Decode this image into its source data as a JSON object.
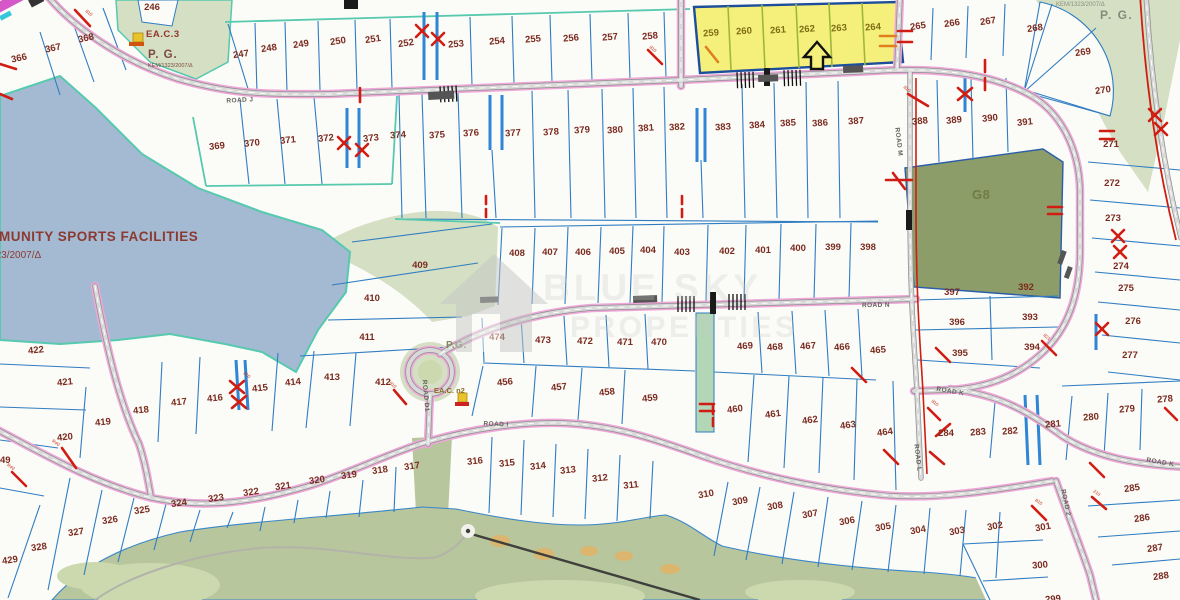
{
  "map": {
    "watermark": {
      "line1": "BLUE SKY",
      "line2": "PROPERTIES"
    },
    "colors": {
      "water": "#a4bad3",
      "green_light": "#d4dfc3",
      "golf": "#b7c69c",
      "golf_light": "#ccd9ae",
      "g8": "#8d9d69",
      "bunker": "#dcb56e",
      "highlight": "#f5f07c",
      "highlight_border": "#1d4e9c",
      "road_pink": "#efa6d9",
      "boundary_blue": "#2f7dc2",
      "teal": "#56c9ae",
      "red_mark": "#cf1d14",
      "orange_mark": "#e07f1e",
      "number": "#7b2b20"
    },
    "region_labels": [
      {
        "id": "community",
        "text": "COMMUNITY SPORTS FACILITIES",
        "x": -34,
        "y": 241,
        "size": 13.5,
        "color": "#8a3a30",
        "bold": true,
        "spacing": 0.5,
        "anchor": "start"
      },
      {
        "id": "community-ref",
        "text": "ΚΕΜ/1323/2007/Δ",
        "x": -40,
        "y": 258,
        "size": 10,
        "color": "#8a3a30",
        "bold": false,
        "spacing": 0,
        "anchor": "start"
      },
      {
        "id": "eac3",
        "text": "EA.C.3",
        "x": 146,
        "y": 37,
        "size": 9.5,
        "color": "#96352a",
        "bold": true,
        "spacing": 0.5,
        "anchor": "start"
      },
      {
        "id": "pg-topleft",
        "text": "P. G.",
        "x": 148,
        "y": 58,
        "size": 11.5,
        "color": "#7d4a40",
        "bold": true,
        "spacing": 1,
        "anchor": "start"
      },
      {
        "id": "kem-topleft",
        "text": "ΚΕΜ/1323/2007/Δ",
        "x": 148,
        "y": 67,
        "size": 5.5,
        "color": "#7d4a40",
        "bold": false,
        "spacing": 0,
        "anchor": "start"
      },
      {
        "id": "kem-topright",
        "text": "ΚΕΜ/1323/2007/Δ",
        "x": 1056,
        "y": 6,
        "size": 6,
        "color": "#8a8f80",
        "bold": false,
        "spacing": 0,
        "anchor": "start"
      },
      {
        "id": "pg-topright",
        "text": "P. G.",
        "x": 1100,
        "y": 19,
        "size": 12,
        "color": "#848b7a",
        "bold": true,
        "spacing": 1.5,
        "anchor": "start"
      },
      {
        "id": "g8",
        "text": "G8",
        "x": 972,
        "y": 199,
        "size": 13,
        "color": "#6d7d45",
        "bold": true,
        "spacing": 0.5,
        "anchor": "start"
      },
      {
        "id": "pg-mid",
        "text": "P.G.",
        "x": 446,
        "y": 348,
        "size": 10,
        "color": "#7d8a5a",
        "bold": true,
        "spacing": 0.5,
        "anchor": "start"
      },
      {
        "id": "eacn2",
        "text": "EA.C. n2",
        "x": 434,
        "y": 393,
        "size": 7.5,
        "color": "#8a6a20",
        "bold": true,
        "spacing": 0,
        "anchor": "start"
      },
      {
        "id": "num-49",
        "text": "49",
        "x": 0,
        "y": 463,
        "size": 9.5,
        "color": "#7b2b20",
        "bold": true,
        "spacing": 0,
        "anchor": "start"
      }
    ],
    "road_labels": [
      {
        "text": "ROAD J",
        "x": 240,
        "y": 102,
        "r": -3
      },
      {
        "text": "ROAD N",
        "x": 876,
        "y": 307,
        "r": -1
      },
      {
        "text": "ROAD M",
        "x": 897,
        "y": 142,
        "r": 83
      },
      {
        "text": "ROAD L",
        "x": 916,
        "y": 458,
        "r": 83
      },
      {
        "text": "ROAD D1",
        "x": 424,
        "y": 396,
        "r": 85
      },
      {
        "text": "ROAD I",
        "x": 496,
        "y": 426,
        "r": 2
      },
      {
        "text": "ROAD K",
        "x": 950,
        "y": 393,
        "r": 10
      },
      {
        "text": "ROAD K",
        "x": 1160,
        "y": 464,
        "r": 10
      },
      {
        "text": "ROAD 2",
        "x": 1064,
        "y": 503,
        "r": 78
      }
    ],
    "mark_labels": [
      {
        "t": "810",
        "x": 88,
        "y": 14,
        "r": 40
      },
      {
        "t": "810",
        "x": 652,
        "y": 50,
        "r": 40
      },
      {
        "t": "810",
        "x": 906,
        "y": 90,
        "r": 40
      },
      {
        "t": "821",
        "x": 1046,
        "y": 338,
        "r": 40
      },
      {
        "t": "810",
        "x": 934,
        "y": 404,
        "r": 40
      },
      {
        "t": "210",
        "x": 1096,
        "y": 494,
        "r": 35
      },
      {
        "t": "810",
        "x": 1038,
        "y": 503,
        "r": 35
      },
      {
        "t": "R40",
        "x": 55,
        "y": 444,
        "r": 35
      },
      {
        "t": "R40",
        "x": 10,
        "y": 468,
        "r": 35
      },
      {
        "t": "810",
        "x": 392,
        "y": 386,
        "r": 40
      },
      {
        "t": "810",
        "x": 246,
        "y": 376,
        "r": 40
      }
    ],
    "plots": [
      {
        "n": "246",
        "x": 152,
        "y": 7
      },
      {
        "n": "247",
        "x": 241,
        "y": 54,
        "r": -8
      },
      {
        "n": "248",
        "x": 269,
        "y": 48,
        "r": -8
      },
      {
        "n": "249",
        "x": 301,
        "y": 44,
        "r": -8
      },
      {
        "n": "250",
        "x": 338,
        "y": 41,
        "r": -8
      },
      {
        "n": "251",
        "x": 373,
        "y": 39,
        "r": -8
      },
      {
        "n": "252",
        "x": 406,
        "y": 43,
        "r": -8
      },
      {
        "n": "253",
        "x": 456,
        "y": 44,
        "r": -5
      },
      {
        "n": "254",
        "x": 497,
        "y": 41,
        "r": -5
      },
      {
        "n": "255",
        "x": 533,
        "y": 39,
        "r": -5
      },
      {
        "n": "256",
        "x": 571,
        "y": 38,
        "r": -5
      },
      {
        "n": "257",
        "x": 610,
        "y": 37,
        "r": -5
      },
      {
        "n": "258",
        "x": 650,
        "y": 36,
        "r": -5
      },
      {
        "n": "259",
        "x": 711,
        "y": 33,
        "r": -4,
        "c": "y"
      },
      {
        "n": "260",
        "x": 744,
        "y": 31,
        "r": -4,
        "c": "y"
      },
      {
        "n": "261",
        "x": 778,
        "y": 30,
        "r": -4,
        "c": "y"
      },
      {
        "n": "262",
        "x": 807,
        "y": 29,
        "r": -4,
        "c": "y"
      },
      {
        "n": "263",
        "x": 839,
        "y": 28,
        "r": -4,
        "c": "y"
      },
      {
        "n": "264",
        "x": 873,
        "y": 27,
        "r": -4,
        "c": "y"
      },
      {
        "n": "265",
        "x": 918,
        "y": 26,
        "r": -8
      },
      {
        "n": "266",
        "x": 952,
        "y": 23,
        "r": -8
      },
      {
        "n": "267",
        "x": 988,
        "y": 21,
        "r": -8
      },
      {
        "n": "268",
        "x": 1035,
        "y": 28,
        "r": -8
      },
      {
        "n": "269",
        "x": 1083,
        "y": 52,
        "r": -8
      },
      {
        "n": "270",
        "x": 1103,
        "y": 90,
        "r": -8
      },
      {
        "n": "271",
        "x": 1111,
        "y": 144
      },
      {
        "n": "272",
        "x": 1112,
        "y": 183
      },
      {
        "n": "273",
        "x": 1113,
        "y": 218
      },
      {
        "n": "274",
        "x": 1121,
        "y": 266
      },
      {
        "n": "275",
        "x": 1126,
        "y": 288
      },
      {
        "n": "276",
        "x": 1133,
        "y": 321
      },
      {
        "n": "277",
        "x": 1130,
        "y": 355
      },
      {
        "n": "278",
        "x": 1165,
        "y": 399,
        "r": -5
      },
      {
        "n": "279",
        "x": 1127,
        "y": 409,
        "r": -5
      },
      {
        "n": "280",
        "x": 1091,
        "y": 417,
        "r": -5
      },
      {
        "n": "281",
        "x": 1053,
        "y": 424,
        "r": -5
      },
      {
        "n": "282",
        "x": 1010,
        "y": 431,
        "r": -5
      },
      {
        "n": "283",
        "x": 978,
        "y": 432,
        "r": -5
      },
      {
        "n": "284",
        "x": 946,
        "y": 433
      },
      {
        "n": "285",
        "x": 1132,
        "y": 488,
        "r": -8
      },
      {
        "n": "286",
        "x": 1142,
        "y": 518,
        "r": -8
      },
      {
        "n": "287",
        "x": 1155,
        "y": 548,
        "r": -8
      },
      {
        "n": "288",
        "x": 1161,
        "y": 576,
        "r": -8
      },
      {
        "n": "299",
        "x": 1053,
        "y": 599,
        "r": -5
      },
      {
        "n": "300",
        "x": 1040,
        "y": 565,
        "r": -5
      },
      {
        "n": "301",
        "x": 1043,
        "y": 527,
        "r": -10
      },
      {
        "n": "302",
        "x": 995,
        "y": 526,
        "r": -10
      },
      {
        "n": "303",
        "x": 957,
        "y": 531,
        "r": -10
      },
      {
        "n": "304",
        "x": 918,
        "y": 530,
        "r": -10
      },
      {
        "n": "305",
        "x": 883,
        "y": 527,
        "r": -10
      },
      {
        "n": "306",
        "x": 847,
        "y": 521,
        "r": -10
      },
      {
        "n": "307",
        "x": 810,
        "y": 514,
        "r": -10
      },
      {
        "n": "308",
        "x": 775,
        "y": 506,
        "r": -10
      },
      {
        "n": "309",
        "x": 740,
        "y": 501,
        "r": -10
      },
      {
        "n": "310",
        "x": 706,
        "y": 494,
        "r": -10
      },
      {
        "n": "311",
        "x": 631,
        "y": 485,
        "r": -6
      },
      {
        "n": "312",
        "x": 600,
        "y": 478,
        "r": -6
      },
      {
        "n": "313",
        "x": 568,
        "y": 470,
        "r": -6
      },
      {
        "n": "314",
        "x": 538,
        "y": 466,
        "r": -6
      },
      {
        "n": "315",
        "x": 507,
        "y": 463,
        "r": -6
      },
      {
        "n": "316",
        "x": 475,
        "y": 461,
        "r": -6
      },
      {
        "n": "317",
        "x": 412,
        "y": 466,
        "r": -8
      },
      {
        "n": "318",
        "x": 380,
        "y": 470,
        "r": -8
      },
      {
        "n": "319",
        "x": 349,
        "y": 475,
        "r": -8
      },
      {
        "n": "320",
        "x": 317,
        "y": 480,
        "r": -8
      },
      {
        "n": "321",
        "x": 283,
        "y": 486,
        "r": -8
      },
      {
        "n": "322",
        "x": 251,
        "y": 492,
        "r": -8
      },
      {
        "n": "323",
        "x": 216,
        "y": 498,
        "r": -8
      },
      {
        "n": "324",
        "x": 179,
        "y": 503,
        "r": -8
      },
      {
        "n": "325",
        "x": 142,
        "y": 510,
        "r": -8
      },
      {
        "n": "326",
        "x": 110,
        "y": 520,
        "r": -8
      },
      {
        "n": "327",
        "x": 76,
        "y": 532,
        "r": -8
      },
      {
        "n": "328",
        "x": 39,
        "y": 547,
        "r": -8
      },
      {
        "n": "429",
        "x": 10,
        "y": 560,
        "r": -8
      },
      {
        "n": "366",
        "x": 19,
        "y": 58,
        "r": -12
      },
      {
        "n": "367",
        "x": 53,
        "y": 48,
        "r": -12
      },
      {
        "n": "368",
        "x": 86,
        "y": 38,
        "r": -12
      },
      {
        "n": "369",
        "x": 217,
        "y": 146,
        "r": -6
      },
      {
        "n": "370",
        "x": 252,
        "y": 143,
        "r": -6
      },
      {
        "n": "371",
        "x": 288,
        "y": 140,
        "r": -6
      },
      {
        "n": "372",
        "x": 326,
        "y": 138,
        "r": -6
      },
      {
        "n": "373",
        "x": 371,
        "y": 138,
        "r": -6
      },
      {
        "n": "374",
        "x": 398,
        "y": 135,
        "r": -4
      },
      {
        "n": "375",
        "x": 437,
        "y": 135,
        "r": -4
      },
      {
        "n": "376",
        "x": 471,
        "y": 133,
        "r": -4
      },
      {
        "n": "377",
        "x": 513,
        "y": 133,
        "r": -4
      },
      {
        "n": "378",
        "x": 551,
        "y": 132,
        "r": -4
      },
      {
        "n": "379",
        "x": 582,
        "y": 130,
        "r": -4
      },
      {
        "n": "380",
        "x": 615,
        "y": 130,
        "r": -4
      },
      {
        "n": "381",
        "x": 646,
        "y": 128,
        "r": -4
      },
      {
        "n": "382",
        "x": 677,
        "y": 127,
        "r": -4
      },
      {
        "n": "383",
        "x": 723,
        "y": 127,
        "r": -4
      },
      {
        "n": "384",
        "x": 757,
        "y": 125,
        "r": -4
      },
      {
        "n": "385",
        "x": 788,
        "y": 123,
        "r": -4
      },
      {
        "n": "386",
        "x": 820,
        "y": 123,
        "r": -4
      },
      {
        "n": "387",
        "x": 856,
        "y": 121,
        "r": -4
      },
      {
        "n": "388",
        "x": 920,
        "y": 121,
        "r": -6
      },
      {
        "n": "389",
        "x": 954,
        "y": 120,
        "r": -6
      },
      {
        "n": "390",
        "x": 990,
        "y": 118,
        "r": -6
      },
      {
        "n": "391",
        "x": 1025,
        "y": 122,
        "r": -6
      },
      {
        "n": "392",
        "x": 1026,
        "y": 287
      },
      {
        "n": "393",
        "x": 1030,
        "y": 317
      },
      {
        "n": "394",
        "x": 1032,
        "y": 347
      },
      {
        "n": "395",
        "x": 960,
        "y": 353
      },
      {
        "n": "396",
        "x": 957,
        "y": 322
      },
      {
        "n": "397",
        "x": 952,
        "y": 292
      },
      {
        "n": "398",
        "x": 868,
        "y": 247
      },
      {
        "n": "399",
        "x": 833,
        "y": 247
      },
      {
        "n": "400",
        "x": 798,
        "y": 248
      },
      {
        "n": "401",
        "x": 763,
        "y": 250
      },
      {
        "n": "402",
        "x": 727,
        "y": 251
      },
      {
        "n": "403",
        "x": 682,
        "y": 252
      },
      {
        "n": "404",
        "x": 648,
        "y": 250
      },
      {
        "n": "405",
        "x": 617,
        "y": 251
      },
      {
        "n": "406",
        "x": 583,
        "y": 252
      },
      {
        "n": "407",
        "x": 550,
        "y": 252
      },
      {
        "n": "408",
        "x": 517,
        "y": 253
      },
      {
        "n": "409",
        "x": 420,
        "y": 265
      },
      {
        "n": "410",
        "x": 372,
        "y": 298
      },
      {
        "n": "411",
        "x": 367,
        "y": 337
      },
      {
        "n": "412",
        "x": 383,
        "y": 382
      },
      {
        "n": "413",
        "x": 332,
        "y": 377
      },
      {
        "n": "414",
        "x": 293,
        "y": 382,
        "r": -6
      },
      {
        "n": "415",
        "x": 260,
        "y": 388,
        "r": -6
      },
      {
        "n": "416",
        "x": 215,
        "y": 398,
        "r": -6
      },
      {
        "n": "417",
        "x": 179,
        "y": 402,
        "r": -6
      },
      {
        "n": "418",
        "x": 141,
        "y": 410,
        "r": -6
      },
      {
        "n": "419",
        "x": 103,
        "y": 422,
        "r": -6
      },
      {
        "n": "420",
        "x": 65,
        "y": 437,
        "r": -6
      },
      {
        "n": "421",
        "x": 65,
        "y": 382,
        "r": -6
      },
      {
        "n": "422",
        "x": 36,
        "y": 350,
        "r": -6
      },
      {
        "n": "456",
        "x": 505,
        "y": 382,
        "r": -6
      },
      {
        "n": "457",
        "x": 559,
        "y": 387,
        "r": -6
      },
      {
        "n": "458",
        "x": 607,
        "y": 392,
        "r": -6
      },
      {
        "n": "459",
        "x": 650,
        "y": 398,
        "r": -6
      },
      {
        "n": "460",
        "x": 735,
        "y": 409,
        "r": -8
      },
      {
        "n": "461",
        "x": 773,
        "y": 414,
        "r": -8
      },
      {
        "n": "462",
        "x": 810,
        "y": 420,
        "r": -8
      },
      {
        "n": "463",
        "x": 848,
        "y": 425,
        "r": -8
      },
      {
        "n": "464",
        "x": 885,
        "y": 432,
        "r": -8
      },
      {
        "n": "465",
        "x": 878,
        "y": 350,
        "r": -4
      },
      {
        "n": "466",
        "x": 842,
        "y": 347,
        "r": -4
      },
      {
        "n": "467",
        "x": 808,
        "y": 346,
        "r": -4
      },
      {
        "n": "468",
        "x": 775,
        "y": 347,
        "r": -4
      },
      {
        "n": "469",
        "x": 745,
        "y": 346,
        "r": -4
      },
      {
        "n": "470",
        "x": 659,
        "y": 342
      },
      {
        "n": "471",
        "x": 625,
        "y": 342
      },
      {
        "n": "472",
        "x": 585,
        "y": 341
      },
      {
        "n": "473",
        "x": 543,
        "y": 340
      },
      {
        "n": "474",
        "x": 497,
        "y": 337
      }
    ]
  }
}
